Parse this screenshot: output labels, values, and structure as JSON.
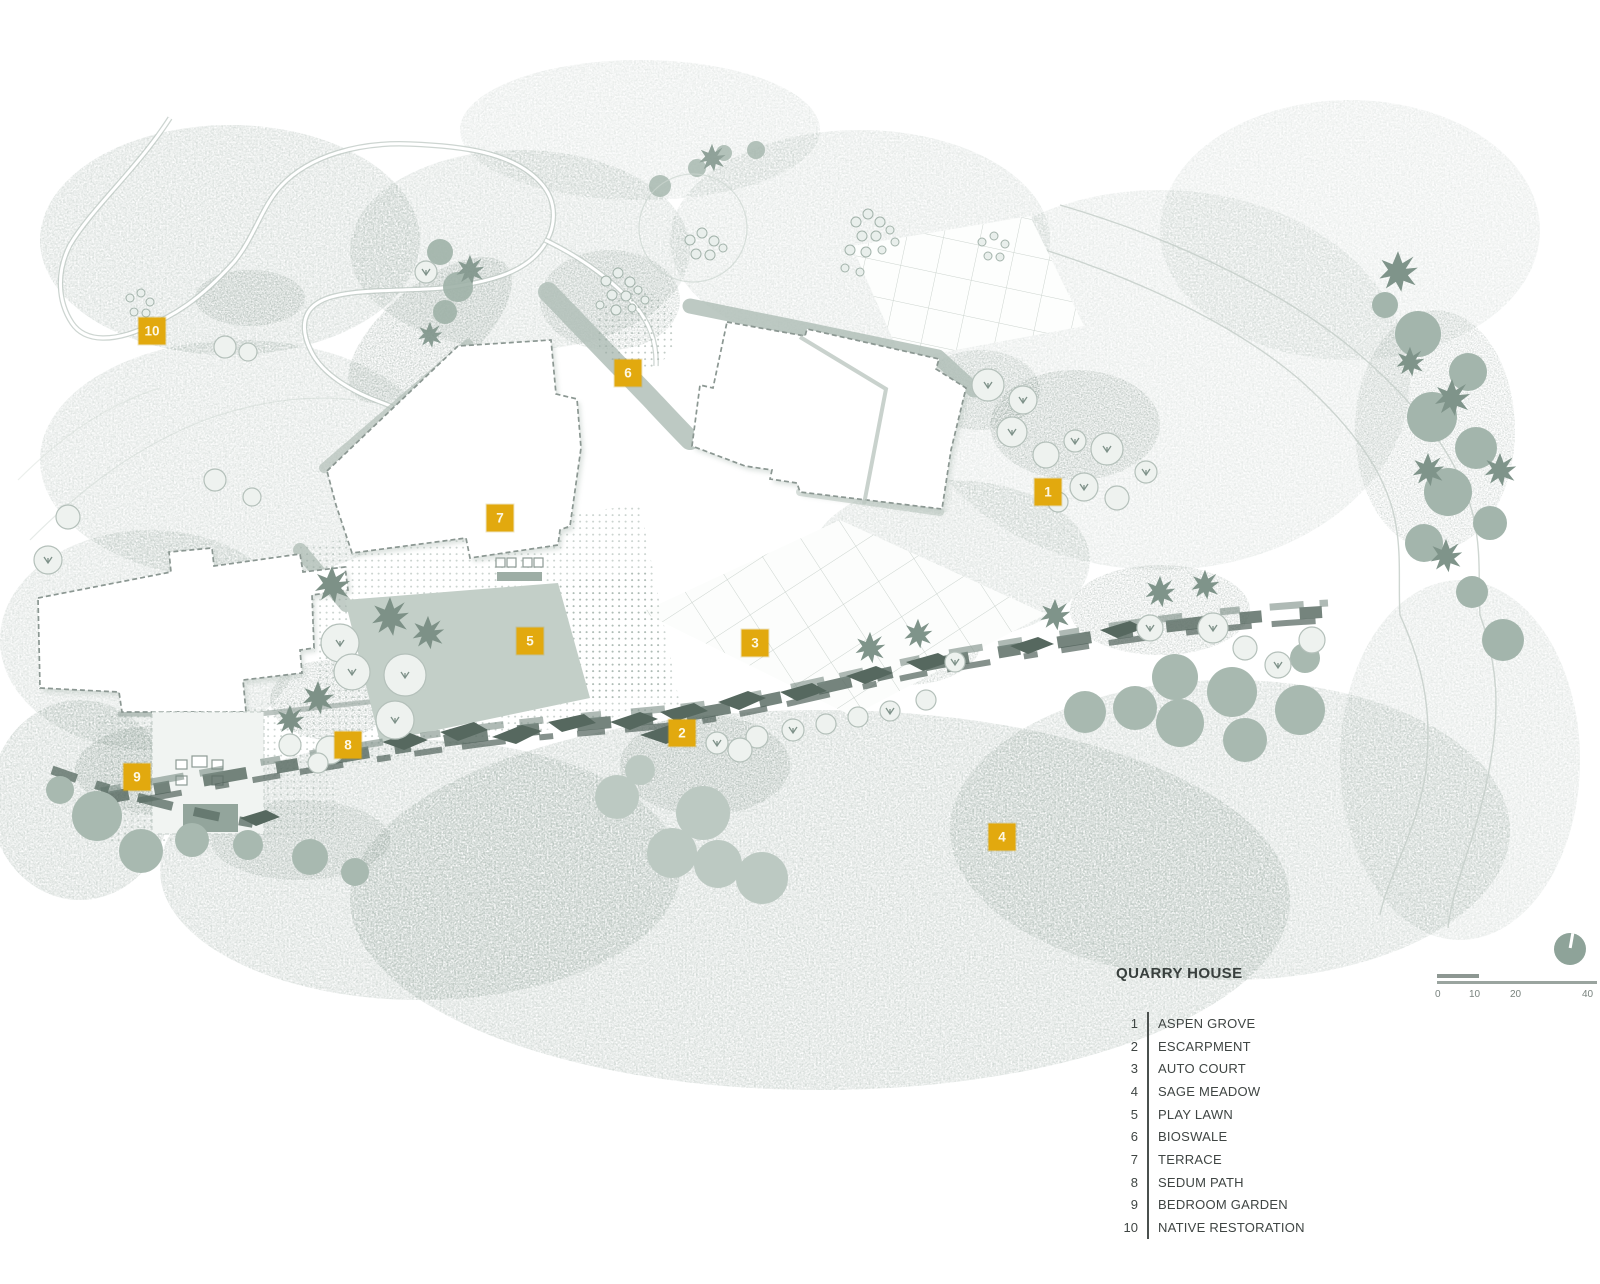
{
  "plan": {
    "title": "QUARRY HOUSE",
    "legend": [
      {
        "num": "1",
        "label": "ASPEN GROVE"
      },
      {
        "num": "2",
        "label": "ESCARPMENT"
      },
      {
        "num": "3",
        "label": "AUTO COURT"
      },
      {
        "num": "4",
        "label": "SAGE MEADOW"
      },
      {
        "num": "5",
        "label": "PLAY LAWN"
      },
      {
        "num": "6",
        "label": "BIOSWALE"
      },
      {
        "num": "7",
        "label": "TERRACE"
      },
      {
        "num": "8",
        "label": "SEDUM PATH"
      },
      {
        "num": "9",
        "label": "BEDROOM GARDEN"
      },
      {
        "num": "10",
        "label": "NATIVE RESTORATION"
      }
    ],
    "markers": [
      {
        "num": "1",
        "x": 1048,
        "y": 492
      },
      {
        "num": "2",
        "x": 682,
        "y": 733
      },
      {
        "num": "3",
        "x": 755,
        "y": 643
      },
      {
        "num": "4",
        "x": 1002,
        "y": 837
      },
      {
        "num": "5",
        "x": 530,
        "y": 641
      },
      {
        "num": "6",
        "x": 628,
        "y": 373
      },
      {
        "num": "7",
        "x": 500,
        "y": 518
      },
      {
        "num": "8",
        "x": 348,
        "y": 745
      },
      {
        "num": "9",
        "x": 137,
        "y": 777
      },
      {
        "num": "10",
        "x": 152,
        "y": 331
      }
    ],
    "scale_bar": {
      "labels": [
        "0",
        "10",
        "20",
        "40"
      ]
    },
    "colors": {
      "marker": "#e2a90e",
      "ink": "#3d4341",
      "escarpment": "#5d6f66",
      "sage": "#a8b9b0"
    }
  }
}
